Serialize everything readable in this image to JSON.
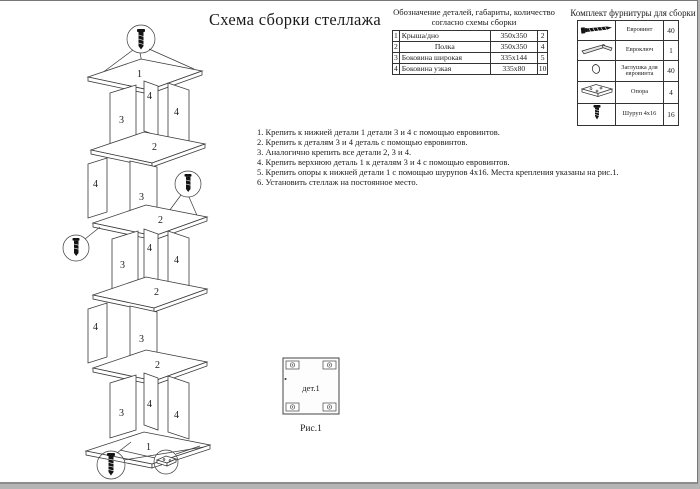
{
  "page": {
    "title": "Схема сборки стеллажа",
    "fig_label": "дет.1",
    "fig_caption": "Рис.1"
  },
  "parts_table": {
    "title_line1": "Обозначение деталей, габариты, количество",
    "title_line2": "согласно схемы сборки",
    "rows": [
      {
        "num": "1",
        "name": "Крыша/дно",
        "size": "350x350",
        "qty": "2"
      },
      {
        "num": "2",
        "name": "Полка",
        "size": "350x350",
        "qty": "4"
      },
      {
        "num": "3",
        "name": "Боковина широкая",
        "size": "335x144",
        "qty": "5"
      },
      {
        "num": "4",
        "name": "Боковина узкая",
        "size": "335x80",
        "qty": "10"
      }
    ]
  },
  "hardware_table": {
    "title": "Комплект фурнитуры для сборки",
    "rows": [
      {
        "icon": "euro-screw-icon",
        "name": "Евровинт",
        "qty": "40"
      },
      {
        "icon": "hex-key-icon",
        "name": "Евроключ",
        "qty": "1"
      },
      {
        "icon": "cap-icon",
        "name": "Заглушка для евровинта",
        "qty": "40"
      },
      {
        "icon": "support-foot-icon",
        "name": "Опора",
        "qty": "4"
      },
      {
        "icon": "wood-screw-icon",
        "name": "Шуруп 4x16",
        "qty": "16"
      }
    ]
  },
  "instructions": [
    "1. Крепить к нижней детали 1 детали 3 и 4 с помощью евровинтов.",
    "2. Крепить к деталям 3 и 4 деталь с помощью евровинтов.",
    "3. Аналогично крепить все детали 2, 3 и 4.",
    "4. Крепить верхнюю деталь 1 к деталям 3 и 4 с помощью евровинтов.",
    "5. Крепить опоры к нижней детали 1 с помощью шурупов 4x16. Места крепления указаны на рис.1.",
    "6. Установить стеллаж на постоянное место."
  ],
  "diagram": {
    "part_labels": {
      "top": "1",
      "shelf": "2",
      "wide": "3",
      "narrow": "4",
      "bottom": "1"
    }
  },
  "colors": {
    "line": "#3a3a3a",
    "text": "#1a1a1a",
    "paper": "#ffffff",
    "outside": "#b5b5b5"
  }
}
